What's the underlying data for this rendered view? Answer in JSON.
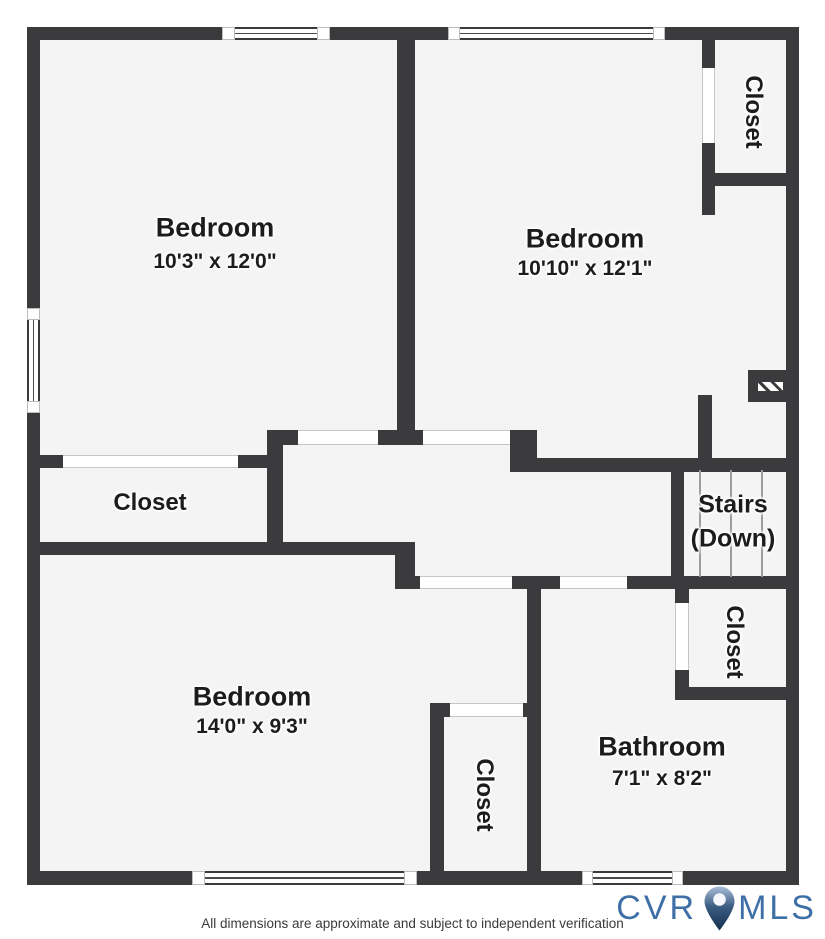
{
  "colors": {
    "wall": "#3b3b3d",
    "floor": "#f4f4f5",
    "logo_blue": "#3e6fa7",
    "pin_dark": "#14304d",
    "pin_light": "#a9bed8"
  },
  "rooms": {
    "bedroom1": {
      "name": "Bedroom",
      "dims": "10'3\" x 12'0\""
    },
    "bedroom2": {
      "name": "Bedroom",
      "dims": "10'10\" x 12'1\""
    },
    "bedroom3": {
      "name": "Bedroom",
      "dims": "14'0\" x 9'3\""
    },
    "bathroom": {
      "name": "Bathroom",
      "dims": "7'1\" x 8'2\""
    },
    "closet_left": {
      "label": "Closet"
    },
    "closet_top_right": {
      "label": "Closet"
    },
    "closet_bottom_center": {
      "label": "Closet"
    },
    "closet_bottom_right": {
      "label": "Closet"
    },
    "stairs": {
      "line1": "Stairs",
      "line2": "(Down)"
    }
  },
  "footer": {
    "disclaimer": "All dimensions are approximate and subject to independent verification",
    "logo_left": "CVR",
    "logo_right": "MLS"
  }
}
